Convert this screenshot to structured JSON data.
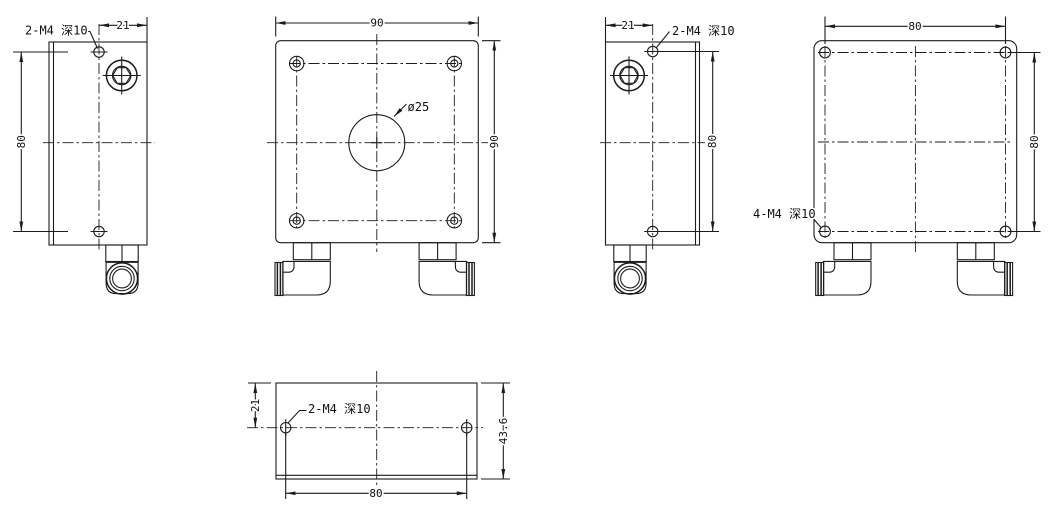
{
  "drawing": {
    "type": "engineering-multiview",
    "background": "#ffffff",
    "line_color": "#1c1c1c",
    "views": {
      "side_left": {
        "title": "left side view",
        "dim_width": "21",
        "dim_height": "80",
        "thread_label": "2-M4 深10"
      },
      "front": {
        "title": "front view",
        "dim_width": "90",
        "dim_height": "90",
        "bore_label": "ø25"
      },
      "side_right": {
        "title": "right side view",
        "dim_width": "21",
        "dim_height": "80",
        "thread_label": "2-M4 深10"
      },
      "rear": {
        "title": "rear view",
        "dim_width": "80",
        "dim_height": "80",
        "thread_label": "4-M4 深10"
      },
      "bottom": {
        "title": "bottom view",
        "dim_offset": "21",
        "dim_depth": "43.6",
        "dim_width": "80",
        "thread_label": "2-M4 深10"
      }
    }
  }
}
